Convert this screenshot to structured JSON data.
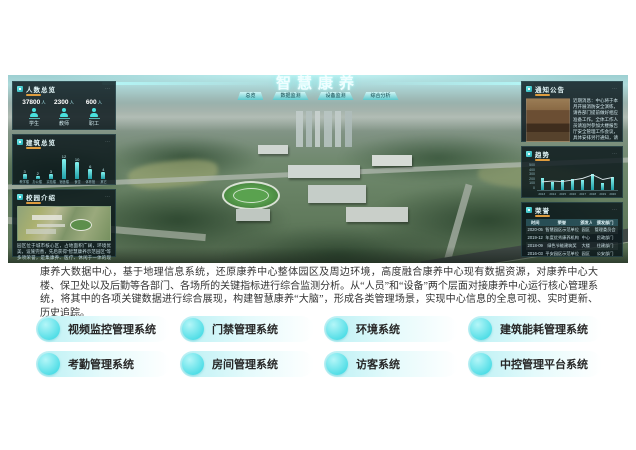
{
  "dashboard": {
    "title": "智慧康养",
    "nav_buttons": [
      "总览",
      "数据监测",
      "设备监测",
      "综合分析"
    ],
    "panels": {
      "people": {
        "title": "人数总览",
        "stats": [
          {
            "value": "37800",
            "unit": "人",
            "label": "学生"
          },
          {
            "value": "2300",
            "unit": "人",
            "label": "教师"
          },
          {
            "value": "600",
            "unit": "人",
            "label": "职工"
          }
        ]
      },
      "buildings": {
        "title": "建筑总览",
        "chart": {
          "type": "bar",
          "categories": [
            "教学楼",
            "办公楼",
            "实验楼",
            "宿舍楼",
            "食堂",
            "体育馆",
            "其它"
          ],
          "values": [
            3,
            2,
            3,
            12,
            10,
            6,
            4
          ]
        }
      },
      "intro": {
        "title": "校园介绍",
        "text": "园区位于城市核心区，占地面积广阔，环境优美，设施完善，先后获得“智慧康养示范园区”等多项荣誉，是集康养、医疗、休闲于一体的现代化综合园区。"
      },
      "notice": {
        "title": "通知公告",
        "text": "近期消息：中心将于本月开展消防安全演练，请各部门提前做好相应准备工作。全体工作人员请准时参加大楼报告厅安全管理工作会议，具体安排另行通知，请留意最新公告信息。"
      },
      "trend": {
        "title": "趋势",
        "chart": {
          "type": "bar+line",
          "x": [
            "2013",
            "2014",
            "2015",
            "2016",
            "2017",
            "2018",
            "2019",
            "2020"
          ],
          "bars": [
            45,
            30,
            40,
            42,
            40,
            60,
            28,
            50
          ],
          "line": [
            30,
            33,
            31,
            37,
            43,
            56,
            39,
            47
          ],
          "y_ticks": [
            "500",
            "400",
            "300",
            "200",
            "100",
            "0"
          ]
        }
      },
      "honors": {
        "title": "荣誉",
        "columns": [
          "时间",
          "荣誉",
          "颁发人",
          "颁发部门"
        ],
        "rows": [
          [
            "2020-05",
            "智慧园区示范单位",
            "园区",
            "管理委员会"
          ],
          [
            "2019-12",
            "年度优秀康养机构",
            "中心",
            "民政部门"
          ],
          [
            "2018-09",
            "绿色节能建筑奖",
            "大楼",
            "住建部门"
          ],
          [
            "2016-03",
            "平安园区示范单位",
            "园区",
            "公安部门"
          ]
        ]
      }
    }
  },
  "description": "康养大数据中心，基于地理信息系统，还原康养中心整体园区及周边环境，高度融合康养中心现有数据资源，对康养中心大楼、保卫处以及后勤等各部门、各场所的关键指标进行综合监测分析。从“人员”和“设备”两个层面对接康养中心运行核心管理系统，将其中的各项关键数据进行综合展现，构建智慧康养“大脑”，形成各类管理场景，实现中心信息的全息可视、实时更新、历史追踪。",
  "systems": [
    "视频监控管理系统",
    "门禁管理系统",
    "环境系统",
    "建筑能耗管理系统",
    "考勤管理系统",
    "房间管理系统",
    "访客系统",
    "中控管理平台系统"
  ],
  "colors": {
    "accent_cyan": "#4fdde6",
    "panel_bg": "#09151a",
    "underline_orange": "#de9c3e"
  }
}
